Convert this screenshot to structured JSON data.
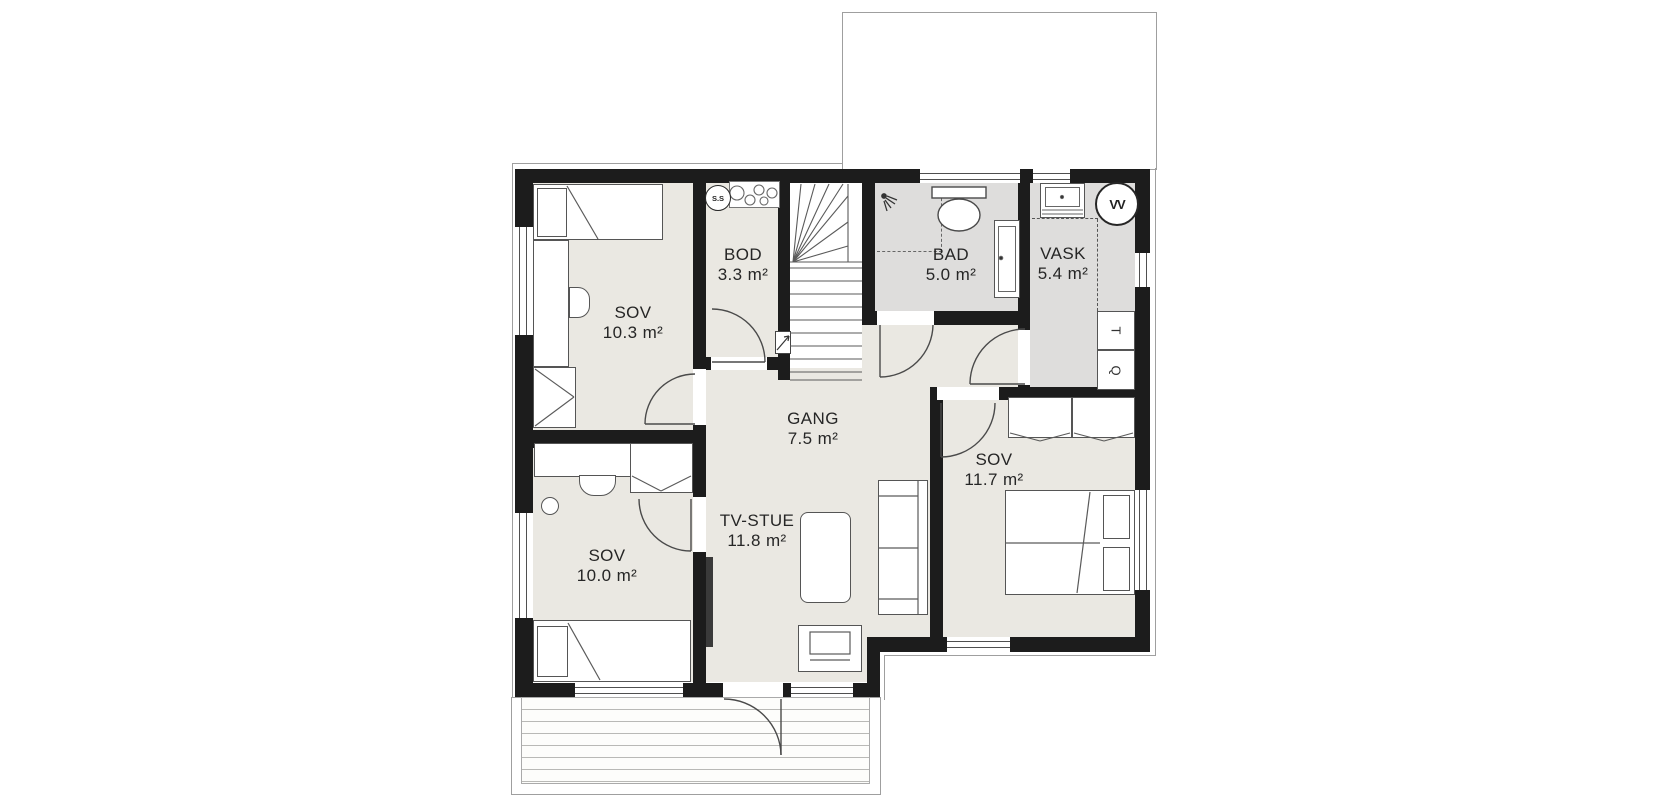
{
  "rooms": [
    {
      "name": "SOV",
      "area": "10.3 m²"
    },
    {
      "name": "BOD",
      "area": "3.3 m²"
    },
    {
      "name": "BAD",
      "area": "5.0 m²"
    },
    {
      "name": "VASK",
      "area": "5.4 m²"
    },
    {
      "name": "GANG",
      "area": "7.5 m²"
    },
    {
      "name": "TV-STUE",
      "area": "11.8 m²"
    },
    {
      "name": "SOV",
      "area": "11.7 m²"
    },
    {
      "name": "SOV",
      "area": "10.0 m²"
    }
  ],
  "symbols": {
    "distribution_cabinet": "S.S",
    "water_heater": "VV",
    "dryer": "T",
    "washing_machine": "Q"
  },
  "colors": {
    "wall": "#1c1c1c",
    "floor": "#eae8e2",
    "wet_floor": "#dedddc",
    "outline": "#9f9f9f",
    "background": "#ffffff"
  }
}
